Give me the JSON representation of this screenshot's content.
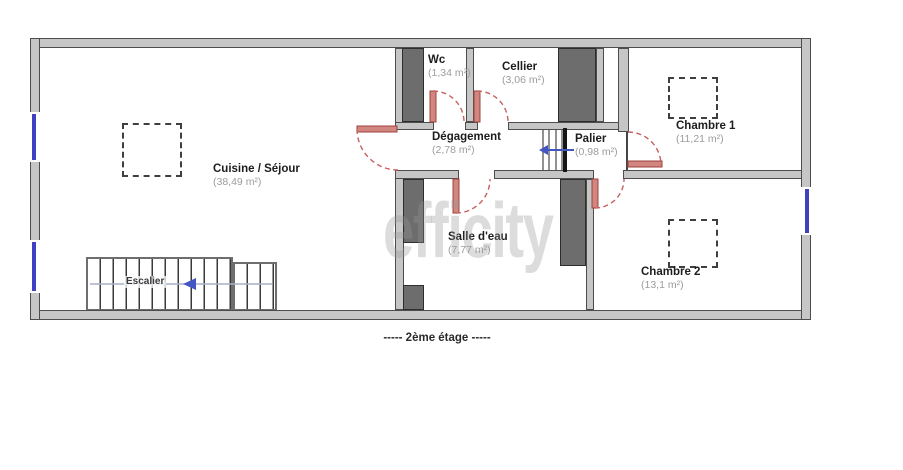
{
  "watermark": {
    "text": "efficity"
  },
  "caption": {
    "text": "-----  2ème étage  -----"
  },
  "stairs": {
    "label": "Escalier"
  },
  "rooms": {
    "cuisine": {
      "name": "Cuisine / Séjour",
      "area": "(38,49 m²)"
    },
    "wc": {
      "name": "Wc",
      "area": "(1,34 m²)"
    },
    "cellier": {
      "name": "Cellier",
      "area": "(3,06 m²)"
    },
    "degagement": {
      "name": "Dégagement",
      "area": "(2,78 m²)"
    },
    "palier": {
      "name": "Palier",
      "area": "(0,98 m²)"
    },
    "chambre1": {
      "name": "Chambre 1",
      "area": "(11,21 m²)"
    },
    "salle_eau": {
      "name": "Salle d'eau",
      "area": "(7,77 m²)"
    },
    "chambre2": {
      "name": "Chambre 2",
      "area": "(13,1 m²)"
    }
  },
  "colors": {
    "wall_fill": "#c6c6c6",
    "wall_dark": "#6d6d6d",
    "door_red": "#c4615c",
    "window_blue": "#4040c2",
    "watermark_gray": "#969696"
  }
}
